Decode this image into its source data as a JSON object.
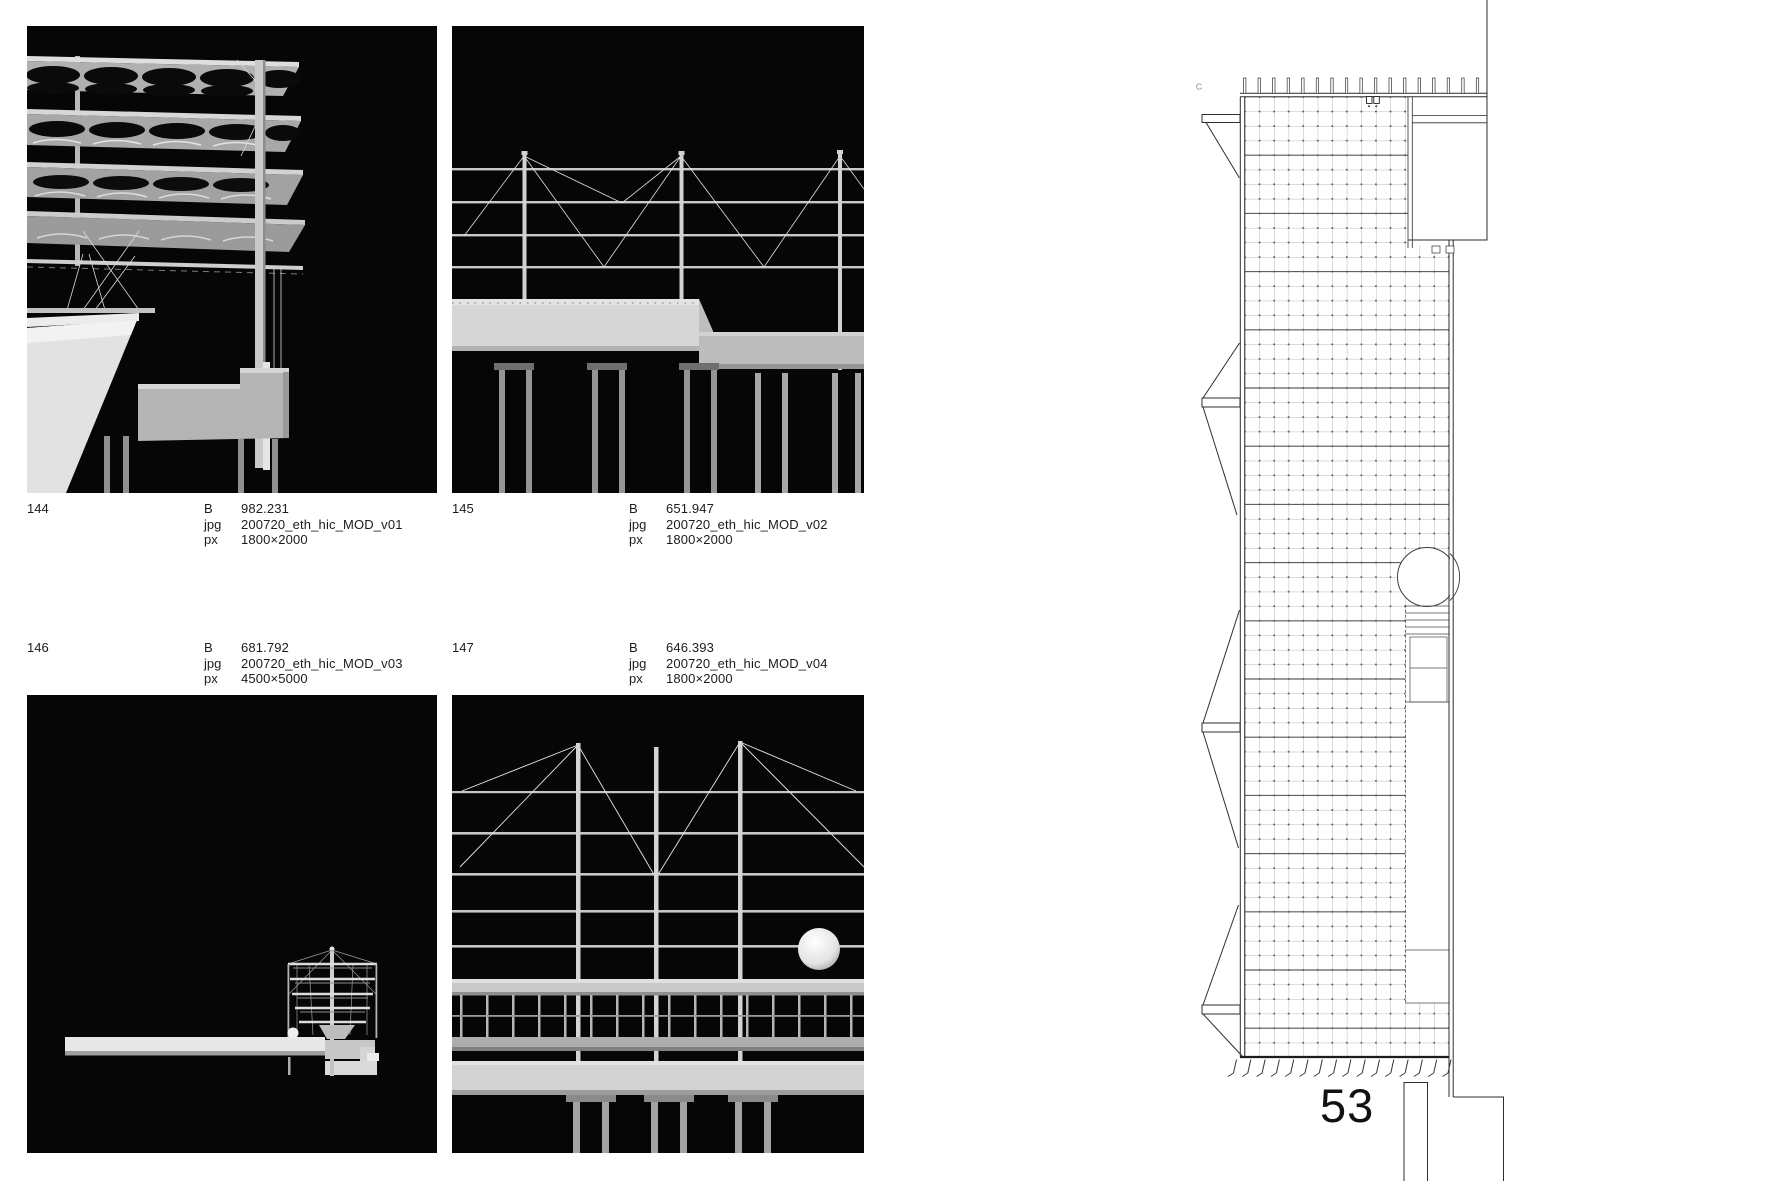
{
  "page": {
    "number": "53"
  },
  "figures": [
    {
      "id": "144",
      "rows": [
        {
          "label": "B",
          "value": "982.231"
        },
        {
          "label": "jpg",
          "value": "200720_eth_hic_MOD_v01"
        },
        {
          "label": "px",
          "value": "1800×2000"
        }
      ]
    },
    {
      "id": "145",
      "rows": [
        {
          "label": "B",
          "value": "651.947"
        },
        {
          "label": "jpg",
          "value": "200720_eth_hic_MOD_v02"
        },
        {
          "label": "px",
          "value": "1800×2000"
        }
      ]
    },
    {
      "id": "146",
      "rows": [
        {
          "label": "B",
          "value": "681.792"
        },
        {
          "label": "jpg",
          "value": "200720_eth_hic_MOD_v03"
        },
        {
          "label": "px",
          "value": "4500×5000"
        }
      ]
    },
    {
      "id": "147",
      "rows": [
        {
          "label": "B",
          "value": "646.393"
        },
        {
          "label": "jpg",
          "value": "200720_eth_hic_MOD_v04"
        },
        {
          "label": "px",
          "value": "1800×2000"
        }
      ]
    }
  ]
}
